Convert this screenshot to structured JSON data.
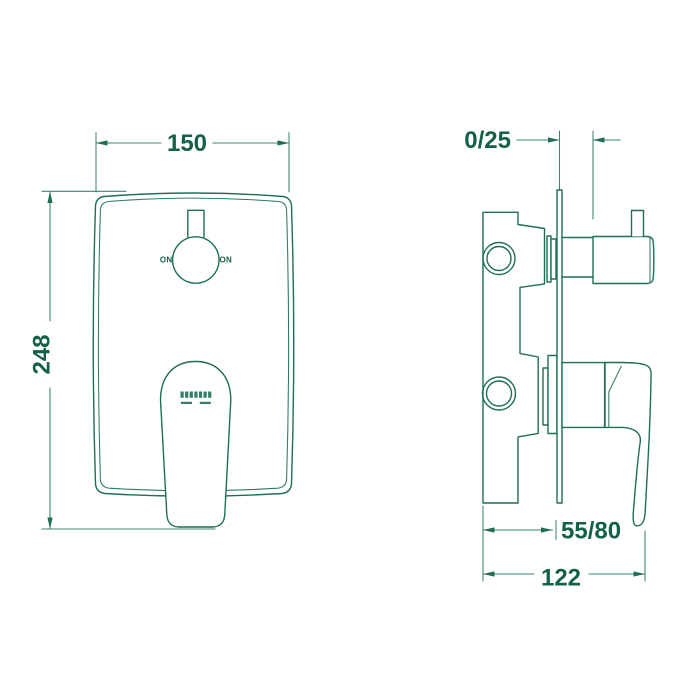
{
  "drawing": {
    "type": "technical-dimension-drawing",
    "subject": "concealed shower mixer valve with diverter, front and side views",
    "line_color": "#1f6e56",
    "text_color": "#156049",
    "background_color": "#ffffff"
  },
  "front_view": {
    "name": "front-view",
    "labels": {
      "knob_left": "ON",
      "knob_right": "ON"
    },
    "dimensions": {
      "width": {
        "label": "150"
      },
      "height": {
        "label": "248"
      }
    }
  },
  "side_view": {
    "name": "side-view",
    "dimensions": {
      "plate_to_knob": {
        "label": "0/25"
      },
      "wall_depth": {
        "label": "55/80"
      },
      "total_depth": {
        "label": "122"
      }
    }
  }
}
